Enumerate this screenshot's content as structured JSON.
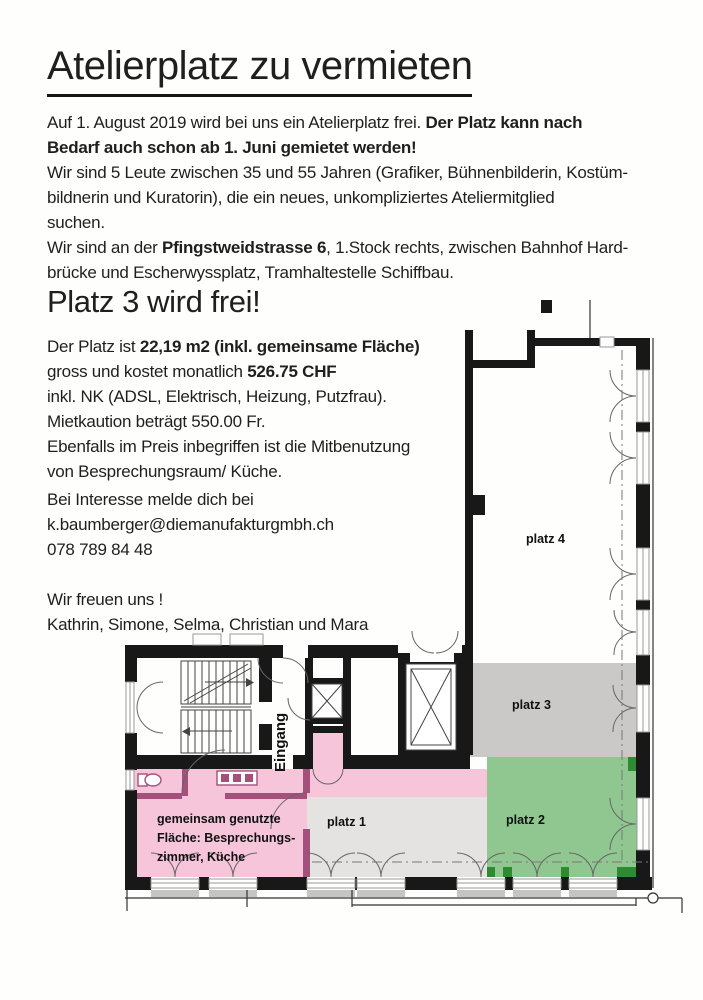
{
  "title": "Atelierplatz zu vermieten",
  "intro": {
    "l1a": "Auf 1. August 2019 wird bei uns ein Atelierplatz frei. ",
    "l1b": "Der Platz kann nach",
    "l2": "Bedarf auch schon ab 1. Juni gemietet werden!",
    "l3": "Wir sind 5 Leute zwischen 35 und 55 Jahren (Grafiker, Bühnenbilderin, Kostüm-",
    "l4": "bildnerin und Kuratorin), die ein neues, unkompliziertes Ateliermitglied",
    "l5": "suchen.",
    "l6a": "Wir sind an der ",
    "l6b": "Pfingstweidstrasse 6",
    "l6c": ", 1.Stock rechts, zwischen Bahnhof Hard-",
    "l7": "brücke und Escherwyssplatz, Tramhaltestelle Schiffbau."
  },
  "section": {
    "heading": "Platz 3 wird frei!",
    "l1a": "Der Platz ist ",
    "l1b": "22,19 m2 (inkl. gemeinsame Fläche)",
    "l2a": "gross und kostet monatlich ",
    "l2b": "526.75 CHF",
    "l3": "inkl. NK (ADSL, Elektrisch, Heizung, Putzfrau).",
    "l4": "Mietkaution beträgt 550.00 Fr.",
    "l5": "Ebenfalls im Preis inbegriffen ist die Mitbenutzung",
    "l6": "von Besprechungsraum/ Küche."
  },
  "contact": {
    "l1": "Bei Interesse melde dich bei",
    "email": "k.baumberger@diemanufakturgmbh.ch",
    "phone": "078 789 84 48",
    "closing": "Wir freuen uns !",
    "names": "Kathrin, Simone, Selma, Christian und Mara"
  },
  "plan": {
    "eingang": "Eingang",
    "platz1": "platz 1",
    "platz2": "platz 2",
    "platz3": "platz 3",
    "platz4": "platz 4",
    "common1": "gemeinsam genutzte",
    "common2": "Fläche: Besprechungs-",
    "common3": "zimmer, Küche"
  },
  "colors": {
    "pink": "#f6c5d9",
    "rose": "#a3507c",
    "light_gray": "#e4e3e1",
    "gray": "#cac9c7",
    "green": "#90c790",
    "dark_green": "#2f8b33",
    "wall": "#181818",
    "text": "#1f1f1f"
  }
}
